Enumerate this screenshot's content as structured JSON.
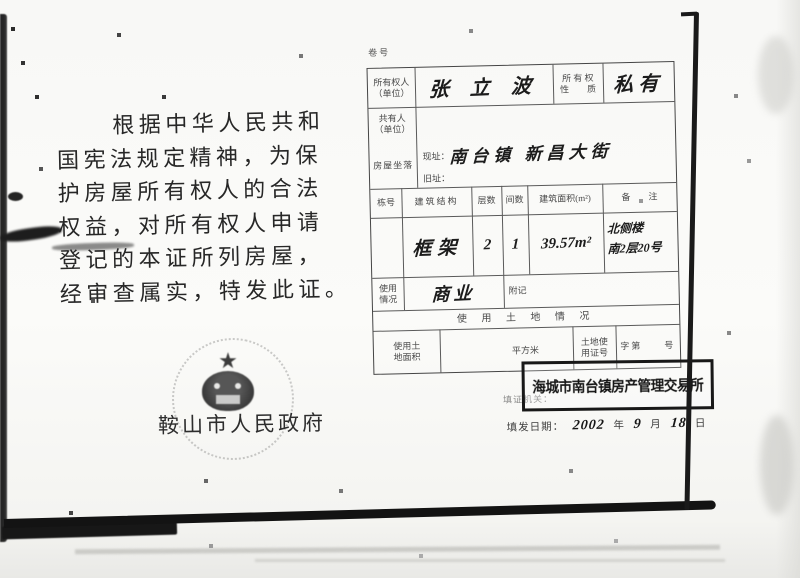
{
  "left_text": {
    "line1": "根据中华人民共和",
    "line2": "国宪法规定精神，为保",
    "line3": "护房屋所有权人的合法",
    "line4": "权益，对所有权人申请",
    "line5": "登记的本证所列房屋，",
    "line6": "经审查属实，特发此证。"
  },
  "seal": {
    "star": "★",
    "authority": "鞍山市人民政府"
  },
  "form": {
    "file_no": "卷号",
    "row1": {
      "owner_label": "所有权人\n（单位）",
      "owner_value": "张 立 波",
      "nature_label": "所 有 权\n性　　质",
      "nature_value": "私有"
    },
    "row2": {
      "co_owner_label": "共有人\n（单位）"
    },
    "row3": {
      "location_label": "房屋坐落",
      "current_label": "现址：",
      "current_value": "南台镇 新昌大街",
      "old_label": "旧址："
    },
    "table": {
      "headers": [
        "栋号",
        "建筑结构",
        "层数",
        "间数",
        "建筑面积(m²)",
        "备　　注"
      ],
      "structure": "框架",
      "floors": "2",
      "rooms": "1",
      "area": "39.57m²",
      "remark1": "北侧楼",
      "remark2": "南2层20号"
    },
    "row6": {
      "usage_label": "使用\n情况",
      "usage_value": "商业",
      "fuji_label": "附记"
    },
    "land": {
      "title": "使 用 土 地 情 况",
      "area_label": "使用土\n地面积",
      "unit": "平方米",
      "cert_label": "土地使\n用证号",
      "cert_value": "字第　　号"
    },
    "issuer": {
      "label": "填证机关：",
      "stamp": "海城市南台镇房产管理交易所"
    },
    "date": {
      "label": "填发日期：",
      "year": "2002",
      "y_unit": "年",
      "month": "9",
      "m_unit": "月",
      "day": "18",
      "d_unit": "日"
    }
  }
}
